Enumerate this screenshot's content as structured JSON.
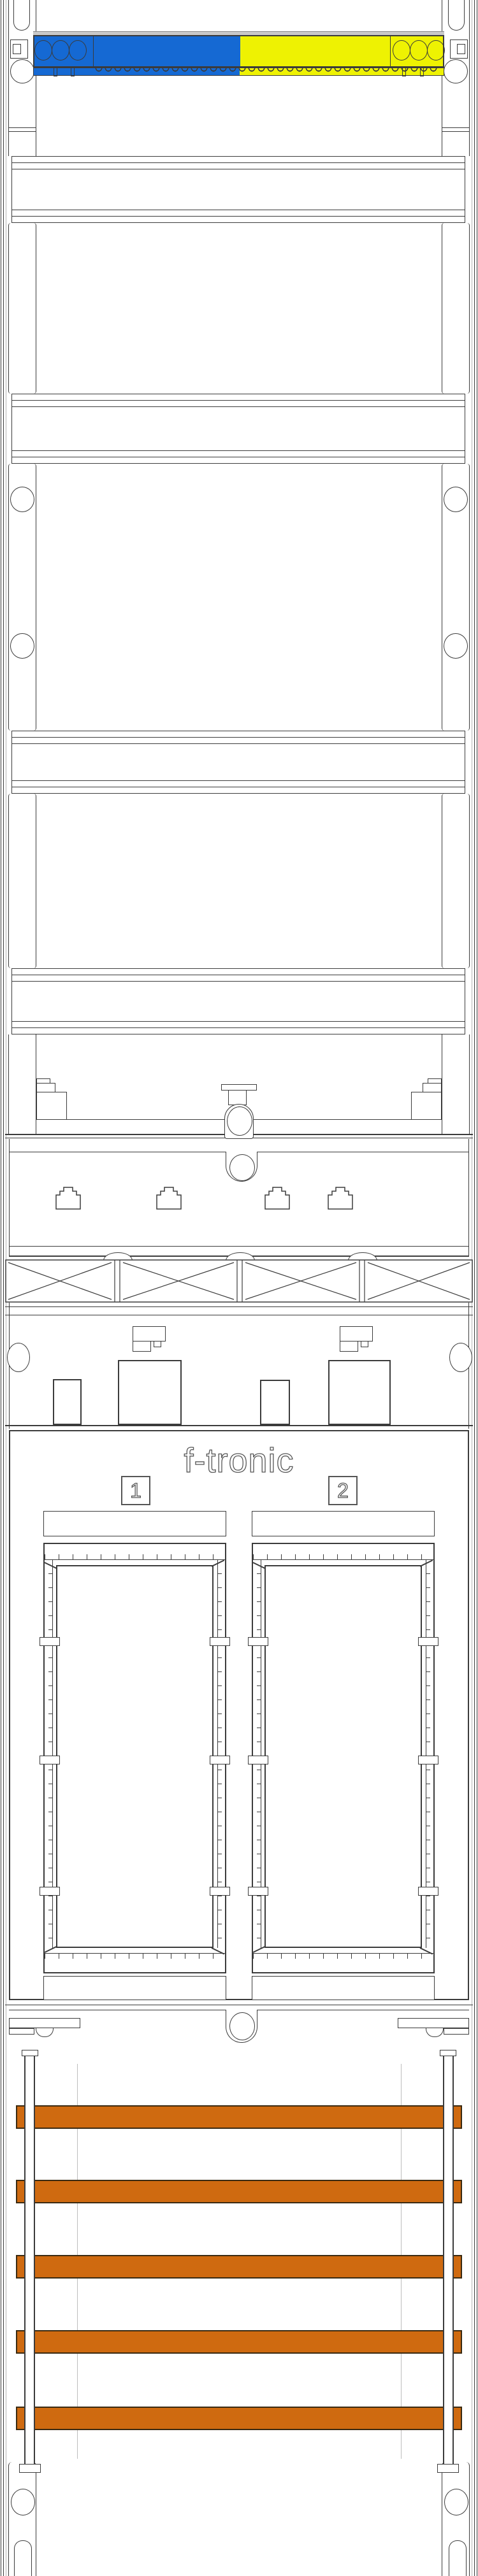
{
  "brand": {
    "logo_text": "f-tronic"
  },
  "meter_fields": [
    {
      "label": "1"
    },
    {
      "label": "2"
    }
  ],
  "colors": {
    "line": "#3b3b3b",
    "neutral_blue": "#1569d3",
    "earth_yellow": "#eef202",
    "busbar_orange": "#cf6a10",
    "shadow_grey": "#c9c9c9",
    "faint_grey": "#bdbdbd"
  },
  "structure": {
    "busbar_count": 5,
    "din_rail_rows": 4,
    "terminal_holes_per_block": 3,
    "lattice_cells": 4,
    "meter_window_count": 2
  }
}
